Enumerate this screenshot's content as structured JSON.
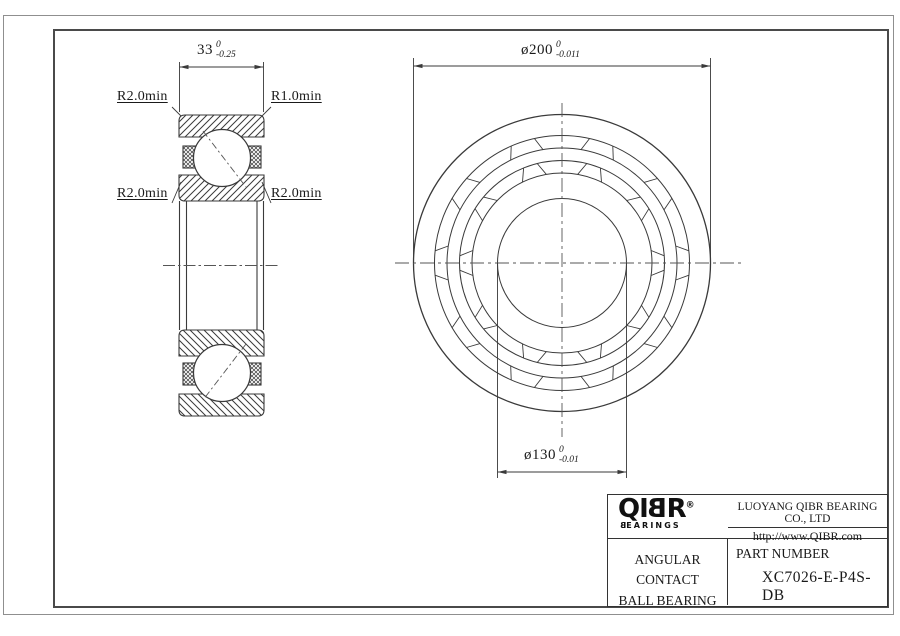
{
  "left_view": {
    "dim_width": {
      "value": "33",
      "tol_upper": "0",
      "tol_lower": "-0.25"
    },
    "labels": {
      "top_left": "R2.0min",
      "top_right": "R1.0min",
      "mid_left": "R2.0min",
      "mid_right": "R2.0min"
    }
  },
  "front_view": {
    "dim_od": {
      "prefix": "ø",
      "value": "200",
      "tol_upper": "0",
      "tol_lower": "-0.011"
    },
    "dim_bore": {
      "prefix": "ø",
      "value": "130",
      "tol_upper": "0",
      "tol_lower": "-0.01"
    }
  },
  "title_block": {
    "logo": {
      "q_i": "QI",
      "b": "B",
      "r": "R",
      "reg": "®",
      "sub_b": "B",
      "sub_rest": "EARINGS"
    },
    "company": "LUOYANG QIBR BEARING CO., LTD",
    "website": "http://www.QIBR.com",
    "product_line1": "ANGULAR CONTACT",
    "product_line2": "BALL BEARING",
    "part_number_label": "PART NUMBER",
    "part_number": "XC7026-E-P4S-DB"
  },
  "colors": {
    "line": "#3a3a3a",
    "centerline": "#555555",
    "frame_outer": "#8f8f8f",
    "frame_inner": "#4a4a4a"
  }
}
